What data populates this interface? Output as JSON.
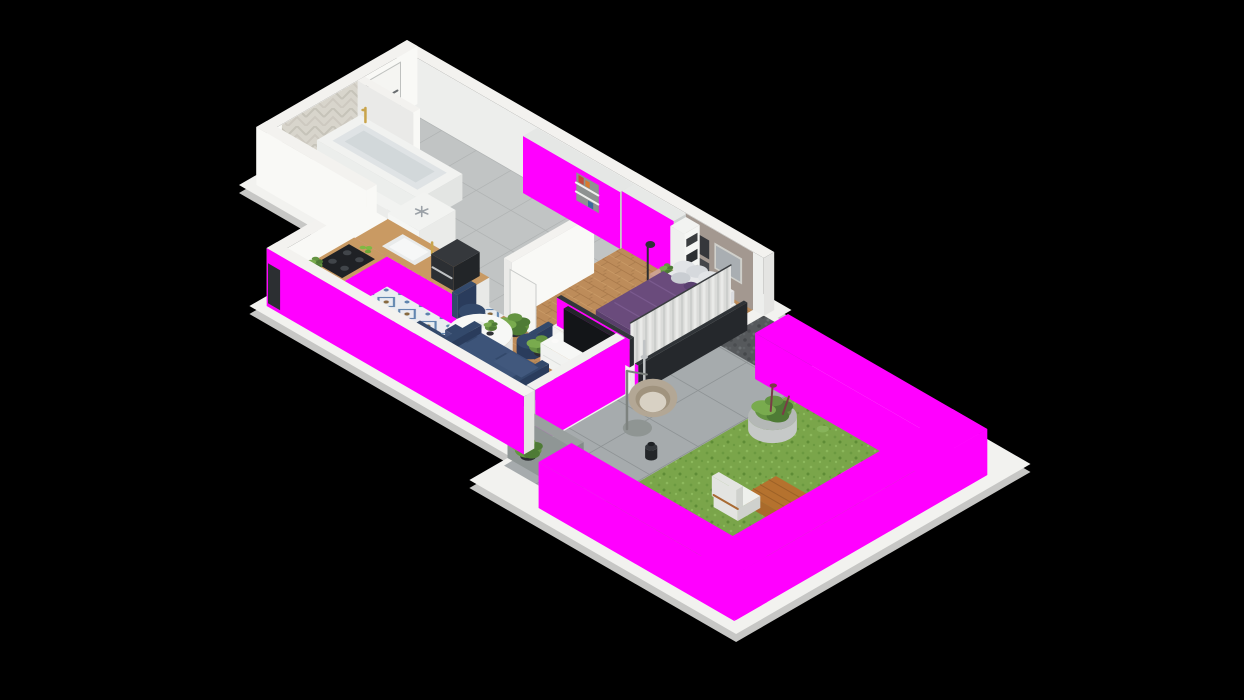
{
  "scene": {
    "title": "Isometric 3D floor plan render of a one-bedroom apartment with terrace and hedged garden",
    "type": "isometric-3d-floor-plan",
    "background": "#000000"
  },
  "colors": {
    "slab": "#f2f2ef",
    "slabSide": "#c7c7c5",
    "wallTop": "#f3f2ef",
    "wallBright": "#f9f9f6",
    "wallMid": "#eaeae8",
    "wallInner": "#edeeec",
    "facadeSide": "#e4e4e2",
    "taupe": "#a39890",
    "navy": "#33496b",
    "navyDark": "#2a3c5c",
    "navyLight": "#3d5479",
    "navyCushion": "#41587d",
    "purple": "#6a4b7c",
    "purpleDark": "#593e6b",
    "purpleSide": "#614473",
    "pillowAccent": "#5a4070",
    "pink": "#c59b8b",
    "pinkTop": "#cda28f",
    "pinkSide": "#b98c79",
    "gold": "#c9a44b",
    "counterWood": "#c99a63",
    "tableWood": "#b5722e",
    "tableWoodSide": "#9c6127",
    "tableWoodEnd": "#a96a2b",
    "dark": "#26292c",
    "tvFrame": "#1a1c1f",
    "tvScreen": "#131518",
    "screenTop": "#9aa09f",
    "screenX": "#848b8a",
    "screenY": "#8f9695",
    "rattan": "#b3a795",
    "rattanIn": "#a0937e",
    "cushionCream": "#d8d1c4",
    "concrete": "#c6c9c8",
    "concreteTop": "#b4b8b6",
    "chairWhite": "#e3e4e1",
    "chairShade": "#cfd1cd",
    "chairCushion": "#eef0ec",
    "red": "#c54b3c",
    "blue": "#3c6aa0",
    "orange": "#d97a2e",
    "orangeDark": "#c8502e",
    "yellow": "#d4b84e",
    "apple": "#7fb943",
    "g1": "#4e7b35",
    "g2": "#649441",
    "g3": "#79ab4e",
    "potDark": "#2c2e31",
    "railDark": "#303438",
    "steel": "#c0c3c5",
    "lampDark": "#2b2d30",
    "sheet": "#e8e9eb",
    "pillowA": "#e2e4e7",
    "pillowB": "#d6d9dd",
    "pillowC": "#c9cdd2",
    "bedBase": "#e9eae8",
    "tubIn": "#dfe3e5",
    "tubIn2": "#d2d8da"
  },
  "rooms": [
    {
      "name": "bathroom",
      "items": [
        "bathtub",
        "gold-faucet",
        "herringbone-tile-wall",
        "step"
      ]
    },
    {
      "name": "hallway",
      "items": [
        "entry-door"
      ]
    },
    {
      "name": "corridor",
      "items": [
        "full-wall-wardrobe",
        "display-niche",
        "built-in-fridge"
      ]
    },
    {
      "name": "kitchen",
      "items": [
        "l-shaped-counter",
        "sink",
        "coffee-machine",
        "induction-hob",
        "green-apples",
        "herb-pot"
      ]
    },
    {
      "name": "dining-area",
      "items": [
        "round-white-table",
        "navy-chair",
        "navy-chair",
        "navy-chair",
        "navy-chair",
        "tableware"
      ]
    },
    {
      "name": "living-room",
      "items": [
        "navy-sofa",
        "tv-sideboard",
        "tv",
        "diamond-pattern-rug",
        "round-coffee-table",
        "potted-plant",
        "glass-wall-with-blinds"
      ]
    },
    {
      "name": "bedroom",
      "items": [
        "double-bed-purple-bedding",
        "pillows",
        "sliding-wardrobe",
        "shelf-unit-with-baskets",
        "nightstand",
        "bench",
        "floor-lamp",
        "wall-art",
        "curtains",
        "accent-wall"
      ]
    },
    {
      "name": "terrace",
      "items": [
        "stone-pavers",
        "hanging-egg-chair",
        "lantern",
        "outdoor-shower",
        "privacy-screen",
        "gravel-strip",
        "balcony-railing"
      ]
    },
    {
      "name": "garden",
      "items": [
        "lawn",
        "boxwood-hedge",
        "concrete-planter-bowl",
        "lounge-chair",
        "lounge-chair",
        "wooden-coffee-table"
      ]
    }
  ]
}
